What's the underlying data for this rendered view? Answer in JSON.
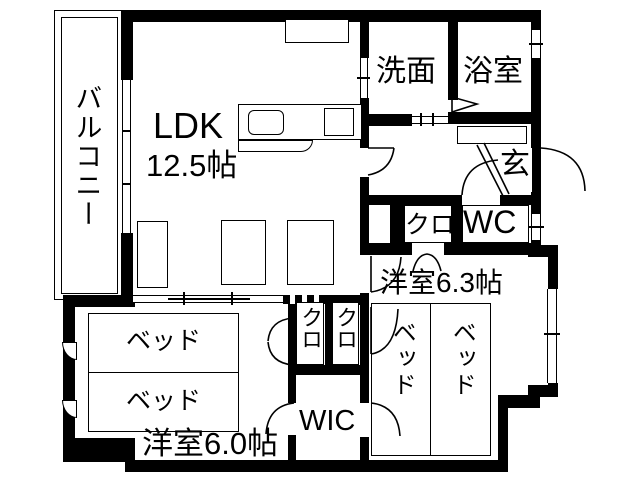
{
  "plan": {
    "title": "apartment-floor-plan",
    "colors": {
      "wall": "#000000",
      "background": "#ffffff",
      "line": "#000000"
    },
    "balcony": {
      "label": "バルコニー"
    },
    "ldk": {
      "label": "LDK",
      "size": "12.5帖"
    },
    "washroom": {
      "label": "洗面"
    },
    "bathroom": {
      "label": "浴室"
    },
    "entrance": {
      "label": "玄"
    },
    "hall_closet": {
      "label": "クロ"
    },
    "toilet": {
      "label": "WC"
    },
    "bedroom_63": {
      "label": "洋室6.3帖",
      "bed1": "ベッド",
      "bed2": "ベッド"
    },
    "bedroom_60": {
      "label": "洋室6.0帖",
      "bed1": "ベッド",
      "bed2": "ベッド"
    },
    "closet_left": {
      "label": "クロ"
    },
    "closet_right": {
      "label": "クロ"
    },
    "wic": {
      "label": "WIC"
    }
  }
}
